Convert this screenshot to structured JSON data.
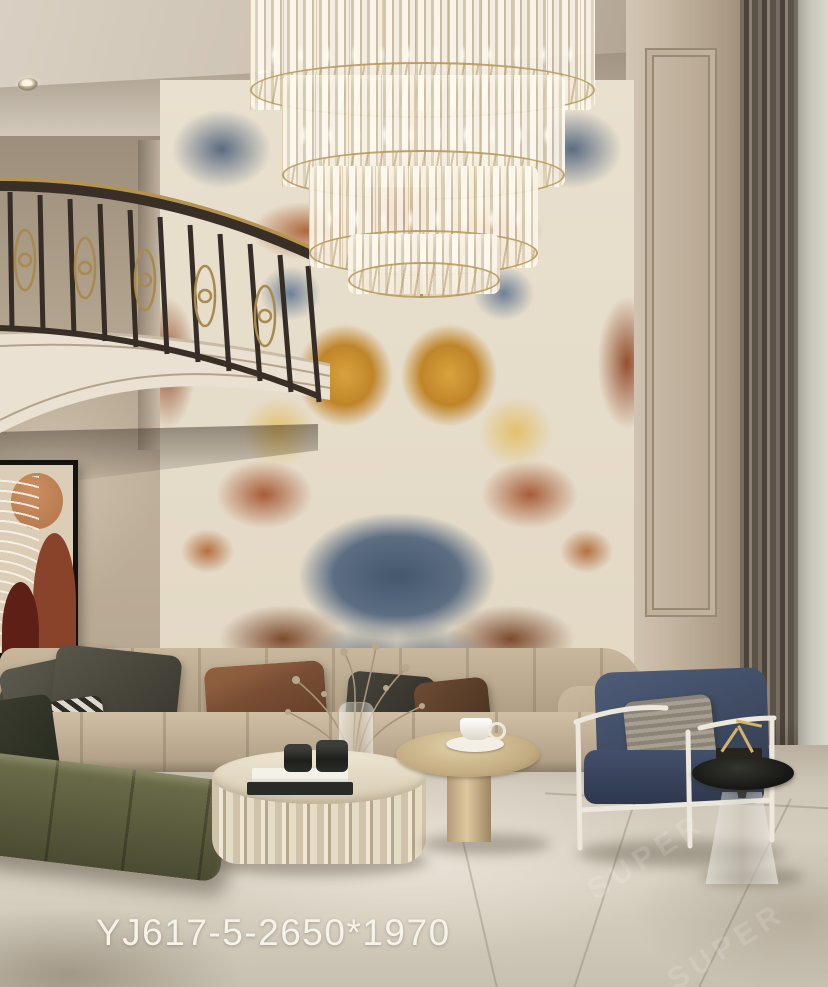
{
  "image": {
    "type": "interior-photograph",
    "subject": "luxury double-height living room with book-matched marble feature wall, tiered crystal chandelier, curved balcony and designer furniture",
    "product_code": "YJ617-5-2650*1970",
    "watermark_text": "SUPER"
  },
  "palette": {
    "marble_blue": "#4c5e74",
    "marble_rust": "#9a4a2b",
    "marble_gold": "#c8892a",
    "marble_cream": "#e7dfce",
    "ceiling_beige": "#cdc3b4",
    "wall_beige": "#c0b19d",
    "curtain_dark": "#554c42",
    "sofa_beige": "#b9a88f",
    "ottoman_olive": "#5c5c3e",
    "armchair_navy": "#41506b",
    "floor_marble": "#d4cdbf",
    "gold_accent": "#b9995c",
    "caption_text": "#f6f3ea"
  }
}
